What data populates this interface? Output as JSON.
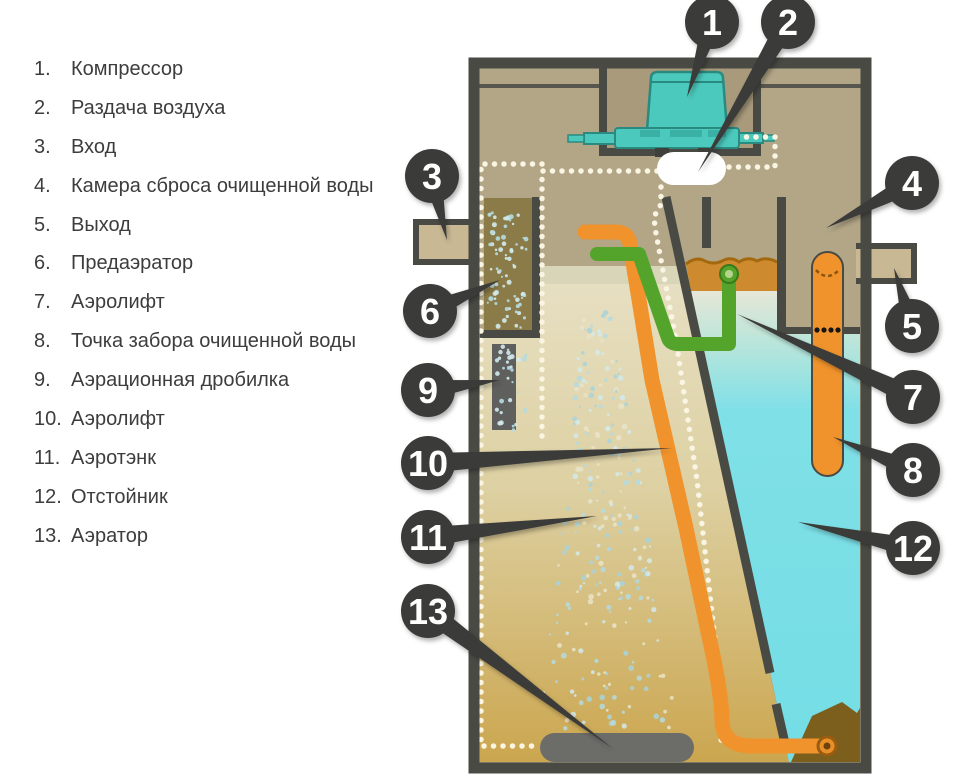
{
  "title": "Схема аэрационного септика (устройство станции биологической очистки)",
  "legend": {
    "items": [
      {
        "num": "1.",
        "label": "Компрессор"
      },
      {
        "num": "2.",
        "label": "Раздача воздуха"
      },
      {
        "num": "3.",
        "label": "Вход"
      },
      {
        "num": "4.",
        "label": "Камера сброса очищенной воды"
      },
      {
        "num": "5.",
        "label": "Выход"
      },
      {
        "num": "6.",
        "label": "Предаэратор"
      },
      {
        "num": "7.",
        "label": "Аэролифт"
      },
      {
        "num": "8.",
        "label": "Точка забора очищенной воды"
      },
      {
        "num": "9.",
        "label": "Аэрационная дробилка"
      },
      {
        "num": "10.",
        "label": "Аэролифт"
      },
      {
        "num": "11.",
        "label": "Аэротэнк"
      },
      {
        "num": "12.",
        "label": "Отстойник"
      },
      {
        "num": "13.",
        "label": "Аэратор"
      }
    ]
  },
  "diagram": {
    "markers": [
      "1",
      "2",
      "3",
      "4",
      "5",
      "6",
      "7",
      "8",
      "9",
      "10",
      "11",
      "12",
      "13"
    ],
    "colors": {
      "tank_wall": "#4a4a45",
      "marker_bubble": "#3b3b39",
      "upper_chamber_tan": "#b2a687",
      "compressor_teal": "#4cc9bd",
      "air_pipe_dotted": "#faf4e2",
      "lift_pipe_orange": "#f0932c",
      "airlift_green": "#54a42b",
      "clean_water_cyan": "#7adfe6",
      "aerotank_sand": "#cba64f",
      "predaerator_brown": "#8b7b48",
      "crust_orange": "#cd8a2f",
      "sludge_brown": "#7c5f1d",
      "aerator_gray": "#6c6c69",
      "inlet_outlet_beige": "#c9b894",
      "legend_text": "#3d3d3d"
    }
  }
}
